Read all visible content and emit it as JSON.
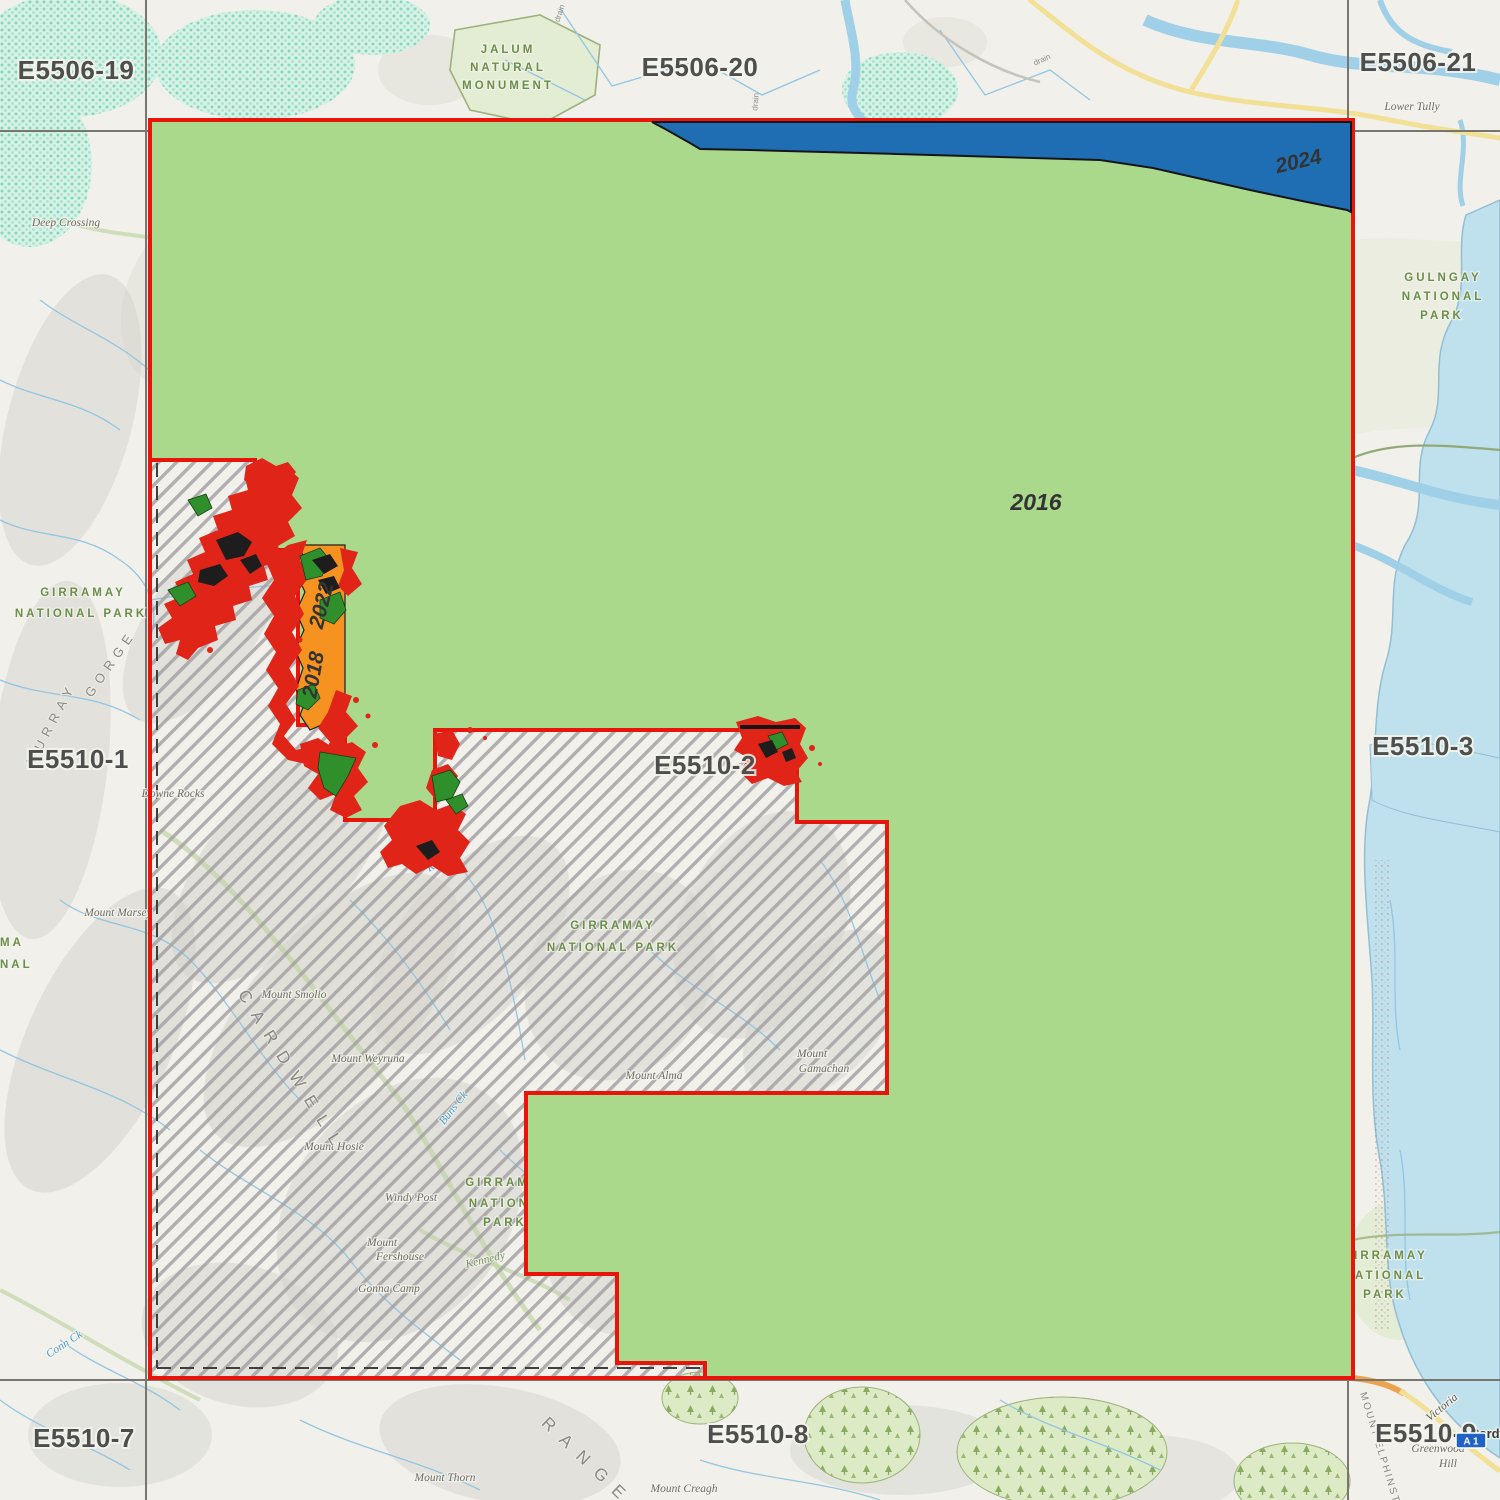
{
  "colors": {
    "green_2016": "#abd98b",
    "blue_2024": "#1f6eb4",
    "orange_year": "#f59220",
    "red_patch": "#e02418",
    "dark_green": "#2f8f2b",
    "boundary_red": "#e8150c",
    "hatch_gray": "#a09da0",
    "ocean": "#bfe1ee",
    "grid_line": "#77766f",
    "label_gray": "#4e4e4c",
    "park_green": "#6b8f4a",
    "water_blue": "#4d9fc9"
  },
  "grid_labels": {
    "tl": "E5506-19",
    "tc": "E5506-20",
    "tr": "E5506-21",
    "ml": "E5510-1",
    "mc": "E5510-2",
    "mr": "E5510-3",
    "bl": "E5510-7",
    "bc": "E5510-8",
    "br": "E5510-9"
  },
  "year_labels": {
    "y2016": "2016",
    "y2024": "2024",
    "y2022": "2022",
    "y2018": "2018"
  },
  "park_labels": {
    "jalum1": "JALUM",
    "jalum2": "NATURAL",
    "jalum3": "MONUMENT",
    "gulngay1": "GULNGAY",
    "gulngay2": "NATIONAL",
    "gulngay3": "PARK",
    "girramay_left1": "GIRRAMAY",
    "girramay_left2": "NATIONAL PARK",
    "girramay_center1": "GIRRAMAY",
    "girramay_center2": "NATIONAL PARK",
    "girramay_bottom1": "GIRRAMAY",
    "girramay_bottom2": "NATIONAL",
    "girramay_bottom3": "PARK",
    "girramay_right1": "GIRRAMAY",
    "girramay_right2": "NATIONAL",
    "girramay_right3": "PARK",
    "edge_partial1": "MA",
    "edge_partial2": "NAL"
  },
  "place_labels": {
    "deep_crossing": "Deep Crossing",
    "lower_tully": "Lower Tully",
    "downe_rocks": "Downe Rocks",
    "mount_marsey": "Mount Marsey",
    "mount_smolio": "Mount Smolio",
    "mount_weyruna": "Mount Weyruna",
    "mount_hosie": "Mount Hosie",
    "windy_post": "Windy Post",
    "mount_fershouse1": "Mount",
    "mount_fershouse2": "Fershouse",
    "gonna_camp": "Gonna Camp",
    "mount_alma": "Mount Alma",
    "mount_gamachan1": "Mount",
    "mount_gamachan2": "Gamachan",
    "mount_creagh": "Mount Creagh",
    "mount_thorn": "Mount Thorn",
    "greenwood1": "Greenwood",
    "greenwood2": "Hill",
    "cardwell_town": "Cardw"
  },
  "water_labels": {
    "murray": "Murray",
    "river1": "River",
    "river2": "River",
    "conn_ck": "Conn Ck",
    "buns_ck": "Buns Ck"
  },
  "range_labels": {
    "cardwell_range": "CARDWELL",
    "range": "RANGE",
    "gorge": "GORGE",
    "murray_gorge": "MURRAY",
    "mount_elphinstone": "MOUNT ELPHINSTONE",
    "kennedy": "Kennedy"
  },
  "road_labels": {
    "victoria": "Victoria",
    "a1": "A 1"
  },
  "tiny_labels": {
    "drain1": "drain",
    "drain2": "drain",
    "drain3": "drain"
  }
}
